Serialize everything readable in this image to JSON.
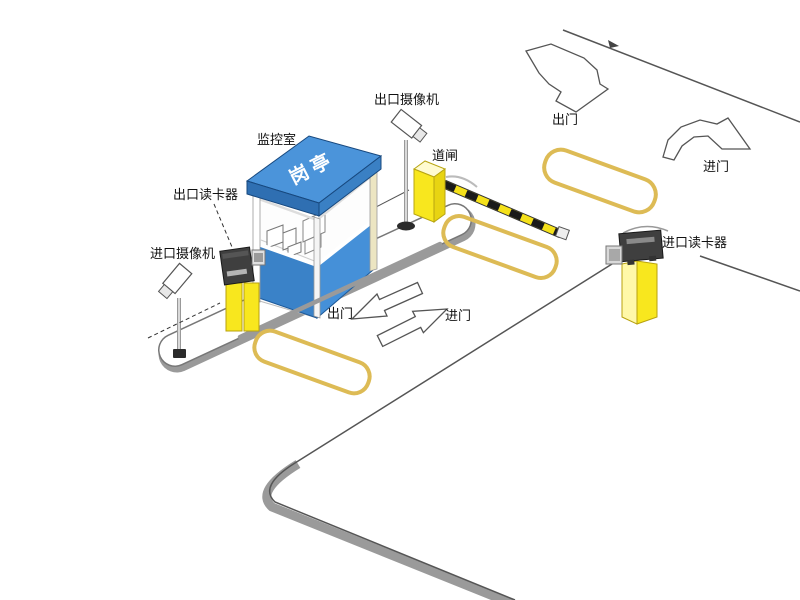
{
  "diagram": {
    "labels": {
      "monitor_room": "监控室",
      "booth_roof": "岗亭",
      "exit_camera": "出口摄像机",
      "barrier_gate": "道闸",
      "exit_card_reader": "出口读卡器",
      "entrance_camera": "进口摄像机",
      "entrance_card_reader": "进口读卡器",
      "exit_door_top": "出门",
      "enter_door_top": "进门",
      "exit_door_lane": "出门",
      "enter_door_lane": "进门"
    },
    "colors": {
      "booth_roof_top": "#4B94DA",
      "booth_roof_left": "#2F6FB2",
      "booth_roof_right": "#3A80C4",
      "booth_wall_left": "#3A82C8",
      "booth_wall_right": "#4590D8",
      "post_yellow": "#F8E71E",
      "post_yellow_light": "#FFF8A8",
      "barrier_yellow": "#F5E11A",
      "barrier_black": "#1A1A1A",
      "loop_yellow": "#DDBB55",
      "curb_gray": "#9A9A9A",
      "line_gray": "#555555",
      "device_dark": "#3F3F3F"
    }
  }
}
